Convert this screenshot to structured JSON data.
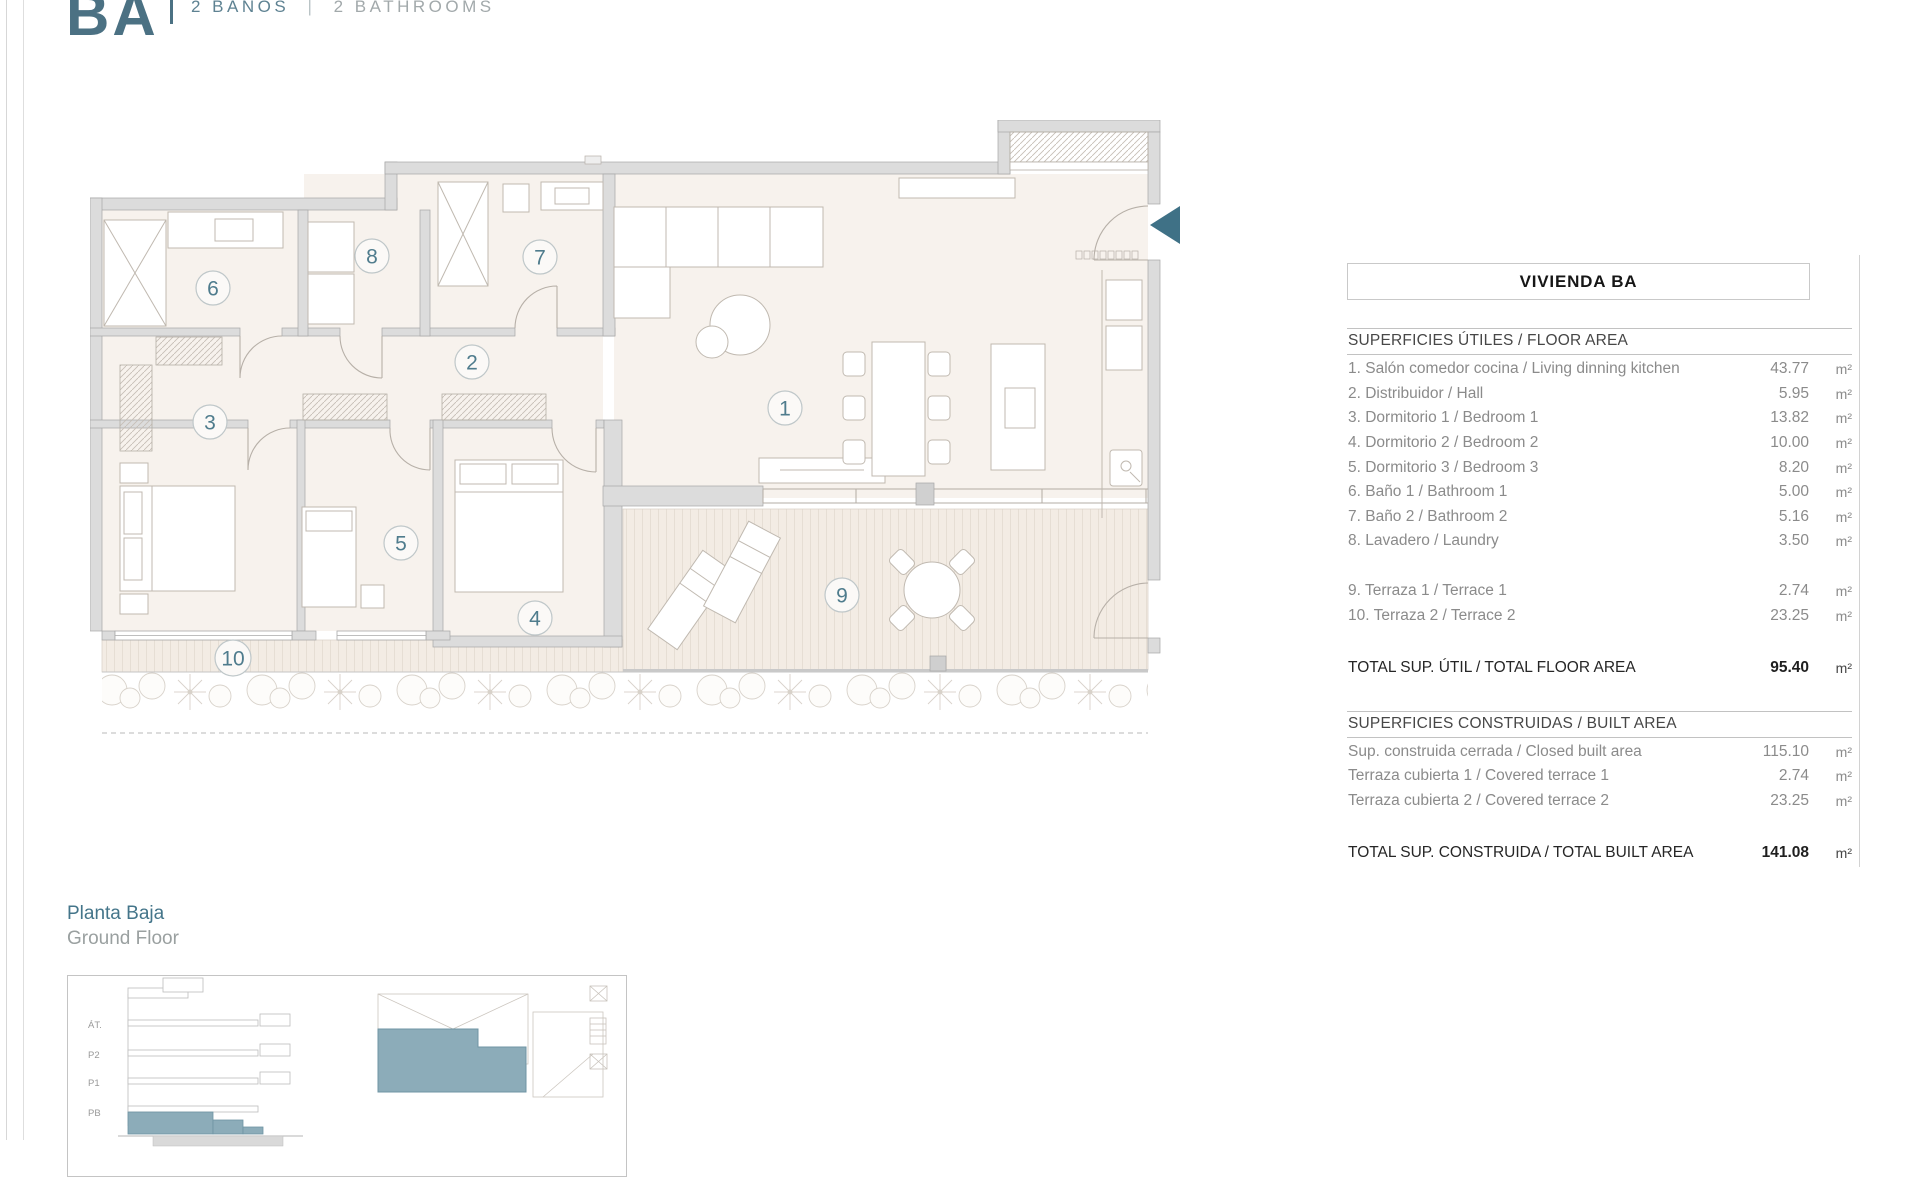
{
  "header": {
    "logo": "BA",
    "sub_es": "2 BAÑOS",
    "sub_sep": "|",
    "sub_en": "2 BATHROOMS"
  },
  "panel": {
    "title": "VIVIENDA BA",
    "floor_area": {
      "heading": "SUPERFICIES ÚTILES / FLOOR AREA",
      "rows": [
        {
          "label": "1. Salón comedor cocina / Living dinning kitchen",
          "value": "43.77",
          "unit": "m²"
        },
        {
          "label": "2. Distribuidor / Hall",
          "value": "5.95",
          "unit": "m²"
        },
        {
          "label": "3. Dormitorio 1 / Bedroom 1",
          "value": "13.82",
          "unit": "m²"
        },
        {
          "label": "4. Dormitorio 2 / Bedroom 2",
          "value": "10.00",
          "unit": "m²"
        },
        {
          "label": "5. Dormitorio 3 / Bedroom 3",
          "value": "8.20",
          "unit": "m²"
        },
        {
          "label": "6. Baño 1 / Bathroom 1",
          "value": "5.00",
          "unit": "m²"
        },
        {
          "label": "7. Baño 2 / Bathroom 2",
          "value": "5.16",
          "unit": "m²"
        },
        {
          "label": "8. Lavadero / Laundry",
          "value": "3.50",
          "unit": "m²"
        }
      ],
      "terrace_rows": [
        {
          "label": "9. Terraza 1 / Terrace 1",
          "value": "2.74",
          "unit": "m²"
        },
        {
          "label": "10. Terraza 2 / Terrace 2",
          "value": "23.25",
          "unit": "m²"
        }
      ],
      "total": {
        "label": "TOTAL SUP. ÚTIL / TOTAL FLOOR AREA",
        "value": "95.40",
        "unit": "m²"
      }
    },
    "built_area": {
      "heading": "SUPERFICIES CONSTRUIDAS / BUILT AREA",
      "rows": [
        {
          "label": "Sup. construida cerrada / Closed built area",
          "value": "115.10",
          "unit": "m²"
        },
        {
          "label": "Terraza cubierta 1 / Covered terrace 1",
          "value": "2.74",
          "unit": "m²"
        },
        {
          "label": "Terraza cubierta 2 / Covered terrace 2",
          "value": "23.25",
          "unit": "m²"
        }
      ],
      "total": {
        "label": "TOTAL SUP. CONSTRUIDA /  TOTAL BUILT AREA",
        "value": "141.08",
        "unit": "m²"
      }
    }
  },
  "plan": {
    "rooms": {
      "r1": "1",
      "r2": "2",
      "r3": "3",
      "r4": "4",
      "r5": "5",
      "r6": "6",
      "r7": "7",
      "r8": "8",
      "r9": "9",
      "r10": "10"
    }
  },
  "footer": {
    "title_es": "Planta Baja",
    "title_en": "Ground Floor",
    "levels": [
      "ÁT.",
      "P2",
      "P1",
      "PB"
    ]
  },
  "colors": {
    "brand_teal": "#4b7183",
    "entrance_arrow": "#3f7186",
    "highlight_teal": "#8cacb9",
    "wall_gray": "#dcdcdc",
    "room_beige": "#f7f2ed"
  }
}
